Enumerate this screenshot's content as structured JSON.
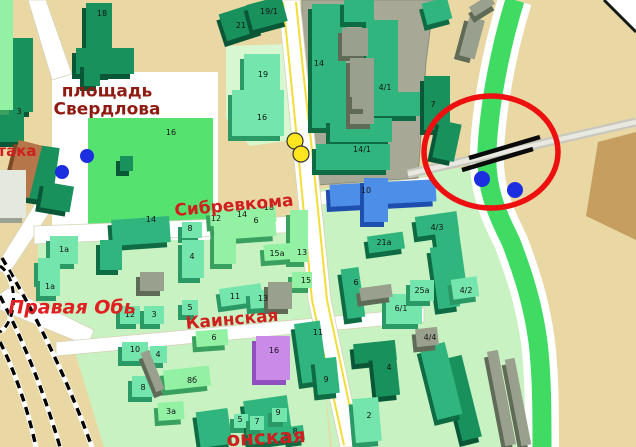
{
  "map": {
    "street_labels": [
      {
        "text": "площадь\nСвердлова",
        "x": 107,
        "y": 101,
        "rot": 0,
        "size": 17,
        "cls": "place"
      },
      {
        "text": "така",
        "x": 17,
        "y": 151,
        "rot": 0,
        "size": 15,
        "cls": ""
      },
      {
        "text": "Сибревкома",
        "x": 234,
        "y": 206,
        "rot": -5,
        "size": 17,
        "cls": ""
      },
      {
        "text": "Каинская",
        "x": 232,
        "y": 320,
        "rot": -5,
        "size": 17,
        "cls": ""
      },
      {
        "text": "Правая Обь",
        "x": 72,
        "y": 308,
        "rot": 0,
        "size": 19,
        "cls": "river"
      },
      {
        "text": "онская",
        "x": 266,
        "y": 438,
        "rot": -3,
        "size": 20,
        "cls": ""
      }
    ],
    "building_labels": [
      [
        "18",
        102,
        14
      ],
      [
        "3",
        19,
        112
      ],
      [
        "16",
        171,
        133
      ],
      [
        "21",
        241,
        26
      ],
      [
        "19/1",
        269,
        12
      ],
      [
        "19",
        263,
        75
      ],
      [
        "16",
        262,
        118
      ],
      [
        "14",
        319,
        64
      ],
      [
        "4/1",
        385,
        88
      ],
      [
        "14/1",
        362,
        150
      ],
      [
        "7",
        433,
        105
      ],
      [
        "10",
        366,
        191
      ],
      [
        "14",
        151,
        220
      ],
      [
        "8",
        190,
        229
      ],
      [
        "4",
        192,
        257
      ],
      [
        "12",
        216,
        219
      ],
      [
        "14",
        242,
        215
      ],
      [
        "18",
        269,
        208
      ],
      [
        "6",
        256,
        221
      ],
      [
        "15а",
        277,
        254
      ],
      [
        "13",
        302,
        253
      ],
      [
        "15",
        306,
        281
      ],
      [
        "11",
        235,
        297
      ],
      [
        "13",
        263,
        299
      ],
      [
        "12",
        130,
        315
      ],
      [
        "3",
        154,
        315
      ],
      [
        "5",
        190,
        308
      ],
      [
        "1а",
        64,
        250
      ],
      [
        "1а",
        50,
        287
      ],
      [
        "10",
        135,
        350
      ],
      [
        "4",
        158,
        355
      ],
      [
        "8",
        143,
        388
      ],
      [
        "8б",
        192,
        381
      ],
      [
        "3а",
        171,
        412
      ],
      [
        "6",
        214,
        338
      ],
      [
        "16",
        274,
        351
      ],
      [
        "11",
        318,
        333
      ],
      [
        "9",
        326,
        380
      ],
      [
        "2",
        369,
        416
      ],
      [
        "4",
        389,
        368
      ],
      [
        "5",
        240,
        420
      ],
      [
        "7",
        257,
        422
      ],
      [
        "9",
        278,
        413
      ],
      [
        "8",
        295,
        432
      ],
      [
        "21а",
        384,
        243
      ],
      [
        "4/3",
        437,
        228
      ],
      [
        "6",
        356,
        283
      ],
      [
        "6/1",
        401,
        309
      ],
      [
        "25а",
        422,
        291
      ],
      [
        "4/2",
        466,
        291
      ],
      [
        "4/4",
        430,
        338
      ]
    ],
    "buildings": [
      {
        "x": 86,
        "y": 3,
        "w": 26,
        "h": 72,
        "t": "d",
        "r": 0
      },
      {
        "x": 76,
        "y": 48,
        "w": 58,
        "h": 26,
        "t": "d",
        "r": 0
      },
      {
        "x": 3,
        "y": 38,
        "w": 30,
        "h": 74,
        "t": "d",
        "r": 0
      },
      {
        "x": 0,
        "y": 112,
        "w": 24,
        "h": 30,
        "t": "d",
        "r": 0
      },
      {
        "x": 30,
        "y": 146,
        "w": 26,
        "h": 54,
        "t": "d",
        "r": 8
      },
      {
        "x": 42,
        "y": 184,
        "w": 30,
        "h": 26,
        "t": "d",
        "r": 10
      },
      {
        "x": 222,
        "y": 8,
        "w": 38,
        "h": 28,
        "t": "d",
        "r": -18
      },
      {
        "x": 249,
        "y": 0,
        "w": 36,
        "h": 26,
        "t": "d",
        "r": -15
      },
      {
        "x": 424,
        "y": 76,
        "w": 26,
        "h": 54,
        "t": "d",
        "r": 0
      },
      {
        "x": 436,
        "y": 122,
        "w": 22,
        "h": 38,
        "t": "d",
        "r": 12
      },
      {
        "x": 354,
        "y": 342,
        "w": 42,
        "h": 20,
        "t": "d",
        "r": -6
      },
      {
        "x": 374,
        "y": 354,
        "w": 24,
        "h": 42,
        "t": "d",
        "r": -6
      },
      {
        "x": 452,
        "y": 356,
        "w": 20,
        "h": 84,
        "t": "d",
        "r": -14
      },
      {
        "x": 84,
        "y": 62,
        "w": 16,
        "h": 24,
        "t": "d",
        "r": 0
      },
      {
        "x": 120,
        "y": 156,
        "w": 13,
        "h": 15,
        "t": "d",
        "r": 0
      },
      {
        "x": 312,
        "y": 4,
        "w": 34,
        "h": 124,
        "t": "m",
        "r": 0
      },
      {
        "x": 344,
        "y": 0,
        "w": 30,
        "h": 22,
        "t": "m",
        "r": 0
      },
      {
        "x": 366,
        "y": 20,
        "w": 32,
        "h": 78,
        "t": "m",
        "r": 0
      },
      {
        "x": 366,
        "y": 92,
        "w": 54,
        "h": 24,
        "t": "m",
        "r": 0
      },
      {
        "x": 330,
        "y": 118,
        "w": 62,
        "h": 24,
        "t": "m",
        "r": 0
      },
      {
        "x": 316,
        "y": 144,
        "w": 74,
        "h": 26,
        "t": "m",
        "r": 0
      },
      {
        "x": 112,
        "y": 218,
        "w": 58,
        "h": 26,
        "t": "m",
        "r": -4
      },
      {
        "x": 100,
        "y": 240,
        "w": 22,
        "h": 30,
        "t": "m",
        "r": 0
      },
      {
        "x": 298,
        "y": 322,
        "w": 26,
        "h": 60,
        "t": "m",
        "r": -8
      },
      {
        "x": 316,
        "y": 358,
        "w": 22,
        "h": 36,
        "t": "m",
        "r": -6
      },
      {
        "x": 246,
        "y": 398,
        "w": 44,
        "h": 44,
        "t": "m",
        "r": -8
      },
      {
        "x": 198,
        "y": 410,
        "w": 32,
        "h": 36,
        "t": "m",
        "r": -8
      },
      {
        "x": 288,
        "y": 426,
        "w": 16,
        "h": 15,
        "t": "m",
        "r": -8
      },
      {
        "x": 368,
        "y": 234,
        "w": 36,
        "h": 17,
        "t": "m",
        "r": -8
      },
      {
        "x": 416,
        "y": 214,
        "w": 42,
        "h": 20,
        "t": "m",
        "r": -8
      },
      {
        "x": 438,
        "y": 228,
        "w": 24,
        "h": 52,
        "t": "m",
        "r": -8
      },
      {
        "x": 344,
        "y": 268,
        "w": 18,
        "h": 50,
        "t": "m",
        "r": -8
      },
      {
        "x": 434,
        "y": 246,
        "w": 22,
        "h": 62,
        "t": "m",
        "r": -8
      },
      {
        "x": 428,
        "y": 344,
        "w": 26,
        "h": 74,
        "t": "m",
        "r": -14
      },
      {
        "x": 424,
        "y": 0,
        "w": 26,
        "h": 22,
        "t": "m",
        "r": -15
      },
      {
        "x": 244,
        "y": 54,
        "w": 36,
        "h": 40,
        "t": "t",
        "r": 0
      },
      {
        "x": 232,
        "y": 90,
        "w": 52,
        "h": 46,
        "t": "t",
        "r": 0
      },
      {
        "x": 50,
        "y": 236,
        "w": 28,
        "h": 28,
        "t": "t",
        "r": 0
      },
      {
        "x": 38,
        "y": 258,
        "w": 22,
        "h": 24,
        "t": "t",
        "r": 0
      },
      {
        "x": 40,
        "y": 276,
        "w": 20,
        "h": 20,
        "t": "t",
        "r": 0
      },
      {
        "x": 182,
        "y": 222,
        "w": 20,
        "h": 16,
        "t": "t",
        "r": 0
      },
      {
        "x": 182,
        "y": 240,
        "w": 22,
        "h": 38,
        "t": "t",
        "r": 0
      },
      {
        "x": 220,
        "y": 286,
        "w": 42,
        "h": 18,
        "t": "t",
        "r": -8
      },
      {
        "x": 250,
        "y": 290,
        "w": 26,
        "h": 18,
        "t": "t",
        "r": -4
      },
      {
        "x": 120,
        "y": 306,
        "w": 20,
        "h": 18,
        "t": "t",
        "r": 0
      },
      {
        "x": 144,
        "y": 306,
        "w": 20,
        "h": 18,
        "t": "t",
        "r": 0
      },
      {
        "x": 182,
        "y": 300,
        "w": 16,
        "h": 15,
        "t": "t",
        "r": 0
      },
      {
        "x": 122,
        "y": 342,
        "w": 26,
        "h": 19,
        "t": "t",
        "r": 0
      },
      {
        "x": 150,
        "y": 346,
        "w": 17,
        "h": 17,
        "t": "t",
        "r": 0
      },
      {
        "x": 132,
        "y": 376,
        "w": 24,
        "h": 21,
        "t": "t",
        "r": 0
      },
      {
        "x": 386,
        "y": 294,
        "w": 36,
        "h": 30,
        "t": "t",
        "r": 0
      },
      {
        "x": 410,
        "y": 280,
        "w": 24,
        "h": 21,
        "t": "t",
        "r": 0
      },
      {
        "x": 452,
        "y": 278,
        "w": 26,
        "h": 20,
        "t": "t",
        "r": -8
      },
      {
        "x": 354,
        "y": 398,
        "w": 26,
        "h": 44,
        "t": "t",
        "r": -5
      },
      {
        "x": 272,
        "y": 408,
        "w": 15,
        "h": 14,
        "t": "t",
        "r": 0
      },
      {
        "x": 234,
        "y": 414,
        "w": 14,
        "h": 14,
        "t": "t",
        "r": 0
      },
      {
        "x": 250,
        "y": 416,
        "w": 14,
        "h": 14,
        "t": "t",
        "r": 0
      },
      {
        "x": 210,
        "y": 208,
        "w": 66,
        "h": 16,
        "t": "p",
        "r": -4
      },
      {
        "x": 214,
        "y": 222,
        "w": 62,
        "h": 16,
        "t": "p",
        "r": -4
      },
      {
        "x": 214,
        "y": 234,
        "w": 22,
        "h": 30,
        "t": "p",
        "r": 0
      },
      {
        "x": 290,
        "y": 210,
        "w": 18,
        "h": 52,
        "t": "p",
        "r": 0
      },
      {
        "x": 264,
        "y": 244,
        "w": 28,
        "h": 16,
        "t": "p",
        "r": -4
      },
      {
        "x": 292,
        "y": 272,
        "w": 20,
        "h": 16,
        "t": "p",
        "r": 0
      },
      {
        "x": 196,
        "y": 330,
        "w": 32,
        "h": 16,
        "t": "p",
        "r": -4
      },
      {
        "x": 164,
        "y": 368,
        "w": 46,
        "h": 20,
        "t": "p",
        "r": -6
      },
      {
        "x": 158,
        "y": 402,
        "w": 26,
        "h": 18,
        "t": "p",
        "r": -4
      },
      {
        "x": 0,
        "y": 0,
        "w": 13,
        "h": 110,
        "t": "p",
        "r": 0
      },
      {
        "x": 330,
        "y": 182,
        "w": 106,
        "h": 22,
        "t": "b",
        "r": -3
      },
      {
        "x": 364,
        "y": 178,
        "w": 24,
        "h": 44,
        "t": "b",
        "r": 0
      },
      {
        "x": 256,
        "y": 336,
        "w": 34,
        "h": 44,
        "t": "u",
        "r": 0
      },
      {
        "x": 12,
        "y": 142,
        "w": 24,
        "h": 54,
        "t": "w",
        "r": 14
      },
      {
        "x": 342,
        "y": 28,
        "w": 26,
        "h": 28,
        "t": "g",
        "r": 0
      },
      {
        "x": 350,
        "y": 58,
        "w": 24,
        "h": 66,
        "t": "g",
        "r": 0
      },
      {
        "x": 352,
        "y": 92,
        "w": 15,
        "h": 17,
        "t": "g",
        "r": 0
      },
      {
        "x": 464,
        "y": 18,
        "w": 16,
        "h": 40,
        "t": "g",
        "r": 15
      },
      {
        "x": 470,
        "y": 0,
        "w": 24,
        "h": 11,
        "t": "g",
        "r": -32
      },
      {
        "x": 140,
        "y": 272,
        "w": 24,
        "h": 19,
        "t": "g",
        "r": 0
      },
      {
        "x": 268,
        "y": 282,
        "w": 24,
        "h": 27,
        "t": "g",
        "r": 0
      },
      {
        "x": 360,
        "y": 286,
        "w": 32,
        "h": 13,
        "t": "g",
        "r": -8
      },
      {
        "x": 496,
        "y": 350,
        "w": 11,
        "h": 96,
        "t": "g",
        "r": -11
      },
      {
        "x": 513,
        "y": 358,
        "w": 10,
        "h": 88,
        "t": "g",
        "r": -11
      },
      {
        "x": 148,
        "y": 350,
        "w": 9,
        "h": 42,
        "t": "g",
        "r": -22
      },
      {
        "x": 416,
        "y": 328,
        "w": 22,
        "h": 18,
        "t": "g",
        "r": -6
      },
      {
        "x": 0,
        "y": 170,
        "w": 26,
        "h": 48,
        "t": "l",
        "r": 0
      }
    ],
    "palette": {
      "d": [
        "#18915d",
        "#0a5737"
      ],
      "m": [
        "#2fb57d",
        "#0e6b44"
      ],
      "t": [
        "#74e5ac",
        "#2a9966"
      ],
      "p": [
        "#93f1a4",
        "#3aa05f"
      ],
      "b": [
        "#4d8fe8",
        "#1f4fae"
      ],
      "u": [
        "#c98ae8",
        "#8f4fc0"
      ],
      "w": [
        "#b5764a",
        "#7a4a26"
      ],
      "g": [
        "#9aa08e",
        "#5f6a57"
      ],
      "l": [
        "#e4e8de",
        "#9aa193"
      ]
    },
    "terrain_colors": {
      "tan": "#ead8a4",
      "pale_green": "#c9f2c2",
      "bright_green": "#55e26e",
      "band_green": "#3fdb63",
      "road_white": "#ffffff",
      "road_yellow": "#f2dd3a",
      "gray_block": "#a7a996",
      "annotation_red": "#ee1010",
      "dot_blue": "#1b2fe0",
      "dot_yellow": "#ffe51e",
      "brown_area": "#c59e60"
    },
    "annotations": {
      "red_ellipse": {
        "cx": 491,
        "cy": 152,
        "rx": 67,
        "ry": 56,
        "stroke_width": 5.5
      },
      "bridge_lines": [
        [
          462,
          170,
          533,
          149
        ],
        [
          469,
          158,
          540,
          137
        ]
      ],
      "blue_dots": [
        [
          62,
          172,
          7
        ],
        [
          87,
          156,
          7
        ],
        [
          482,
          179,
          8
        ],
        [
          515,
          190,
          8
        ]
      ],
      "yellow_dots": [
        [
          295,
          141,
          8
        ],
        [
          301,
          154,
          8
        ]
      ]
    }
  }
}
